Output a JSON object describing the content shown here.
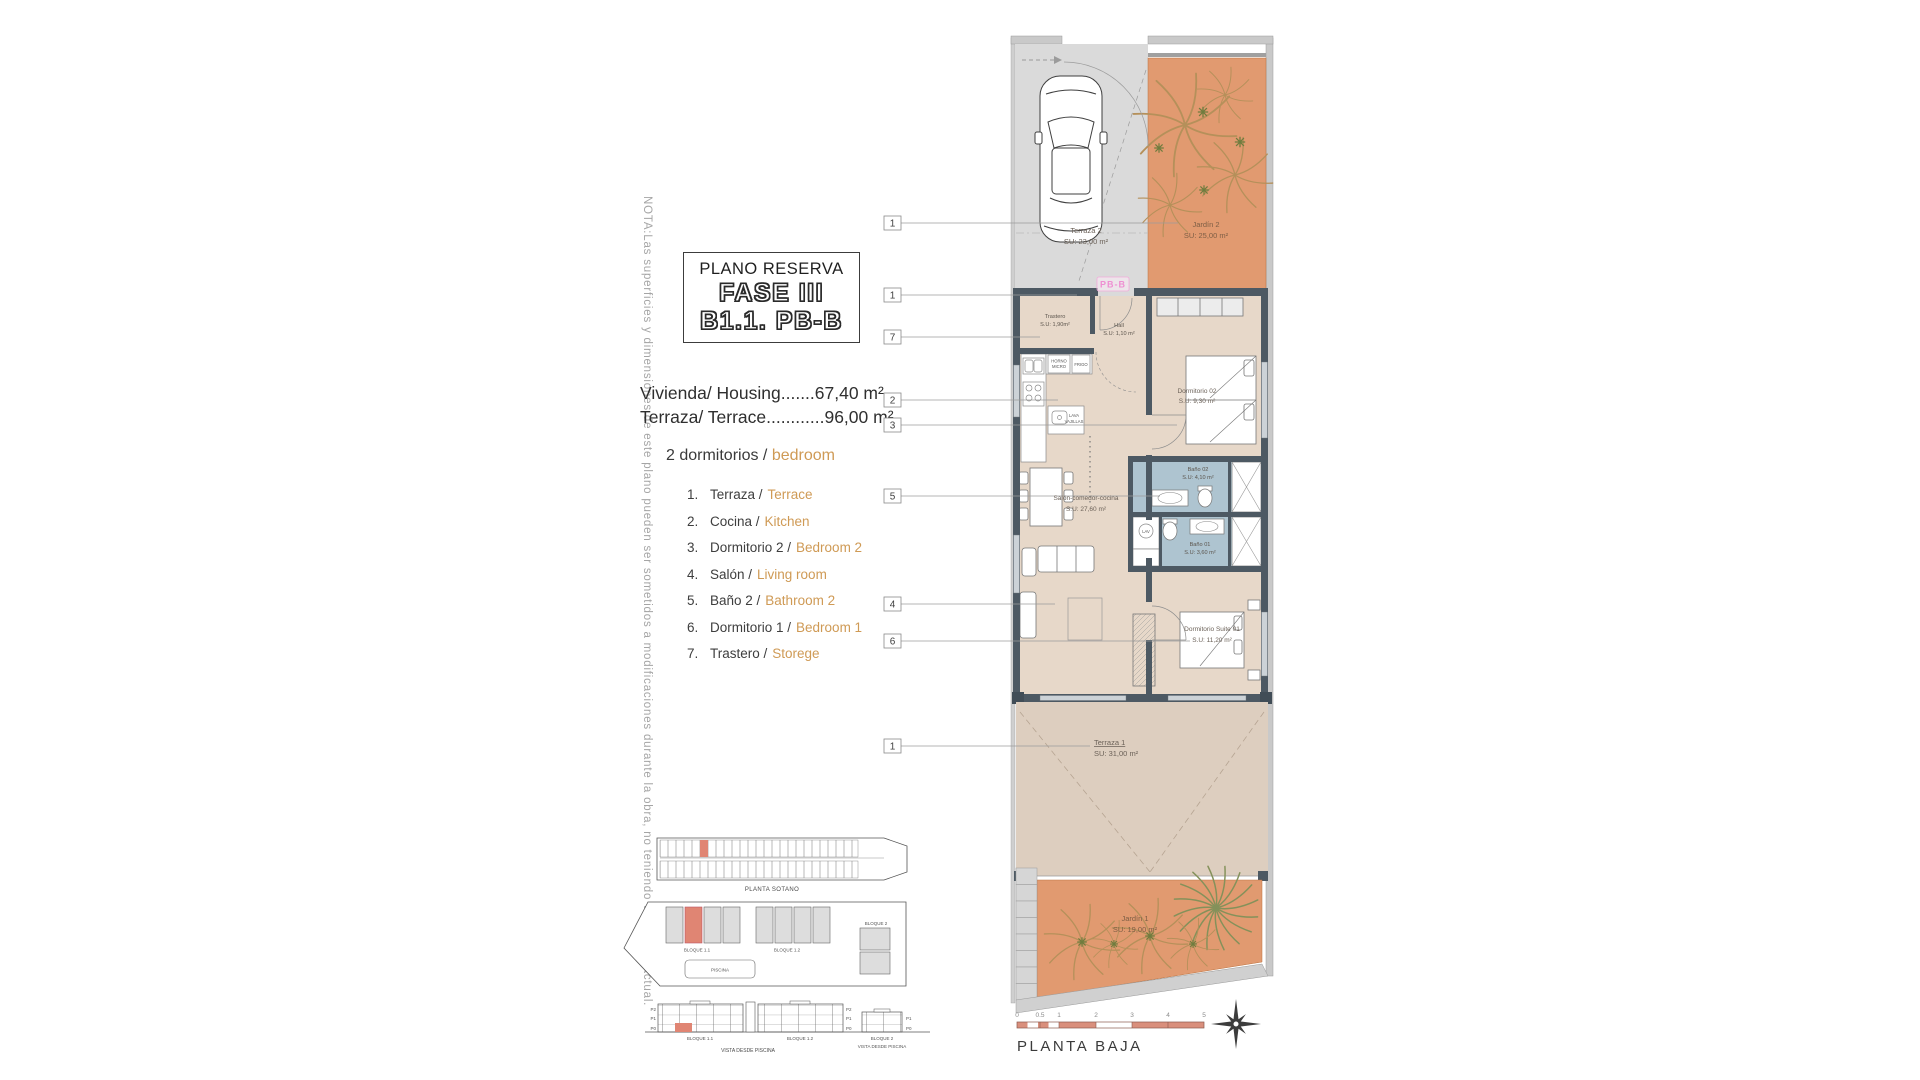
{
  "note": "NOTA:Las superficies y dimensiones de este plano pueden ser sometidos a modificaciones durante la obra, no teniendo valor contractual.",
  "title_block": {
    "subtitle": "PLANO RESERVA",
    "phase": "FASE III",
    "unit": "B1.1. PB-B"
  },
  "summary": {
    "housing_line": "Vivienda/ Housing.......67,40 m²",
    "terrace_line": "Terraza/ Terrace............96,00 m²",
    "bedrooms_es": "2 dormitorios /",
    "bedrooms_en": "bedroom"
  },
  "legend": [
    {
      "num": "1.",
      "es": "Terraza /",
      "en": "Terrace"
    },
    {
      "num": "2.",
      "es": "Cocina /",
      "en": "Kitchen"
    },
    {
      "num": "3.",
      "es": "Dormitorio 2 /",
      "en": "Bedroom 2"
    },
    {
      "num": "4.",
      "es": "Salón /",
      "en": "Living room"
    },
    {
      "num": "5.",
      "es": "Baño 2 /",
      "en": "Bathroom 2"
    },
    {
      "num": "6.",
      "es": "Dormitorio 1 /",
      "en": "Bedroom 1"
    },
    {
      "num": "7.",
      "es": "Trastero /",
      "en": "Storege"
    }
  ],
  "plan": {
    "unit_tag": "PB-B",
    "callouts": [
      "1",
      "1",
      "7",
      "2",
      "3",
      "5",
      "4",
      "6",
      "1"
    ],
    "rooms": {
      "terraza2": {
        "name": "Terraza 2",
        "area": "SU: 23,00 m²"
      },
      "jardin2": {
        "name": "Jardín 2",
        "area": "SU: 25,00 m²"
      },
      "trastero": {
        "name": "Trastero",
        "area": "S.U: 1,90m²"
      },
      "hall": {
        "name": "Hall",
        "area": "S.U: 1,10 m²"
      },
      "dormitorio2": {
        "name": "Dormitorio 02",
        "area": "S.U: 9,30 m²"
      },
      "bano2": {
        "name": "Baño 02",
        "area": "S.U: 4,10 m²"
      },
      "bano1": {
        "name": "Baño 01",
        "area": "S.U: 3,60 m²"
      },
      "salon": {
        "name": "Salón-comedor-cocina",
        "area": "S.U: 27,60 m²"
      },
      "suite": {
        "name": "Dormitorio Suite 01",
        "area": "S.U: 11,20 m²"
      },
      "terraza1": {
        "name": "Terraza 1",
        "area": "SU: 31,00 m²"
      },
      "jardin1": {
        "name": "Jardín 1",
        "area": "SU: 19,00 m²"
      }
    },
    "labels": {
      "horno": "HORNO",
      "micro": "MICRO",
      "frigo": "FRIGO",
      "lava1": "LAVA",
      "lava2": "VAJILLAS",
      "washer": "LAV"
    }
  },
  "site": {
    "d1_caption": "PLANTA SOTANO",
    "bloque11": "BLOQUE 1.1",
    "bloque12": "BLOQUE 1.2",
    "bloque2": "BLOQUE 2",
    "piscina": "PISCINA",
    "vista_caption": "VISTA DESDE PISCINA",
    "floors": [
      "P2",
      "P1",
      "P0"
    ],
    "floors_b2": [
      "P1",
      "P0"
    ]
  },
  "footer": {
    "scale_ticks": [
      "0",
      "0.5",
      "1",
      "2",
      "3",
      "4",
      "5"
    ],
    "caption": "PLANTA BAJA"
  },
  "colors": {
    "garden_orange": "#e19a70",
    "floor_beige": "#e7d8c9",
    "terrace_beige": "#ddcebf",
    "bath_blue": "#aec4d0",
    "wall_dark": "#4d5963",
    "parking_grey": "#dadada",
    "accent_orange_text": "#cf9a55",
    "highlight_red": "#e08573",
    "pink_tag": "#ee8fd2"
  }
}
